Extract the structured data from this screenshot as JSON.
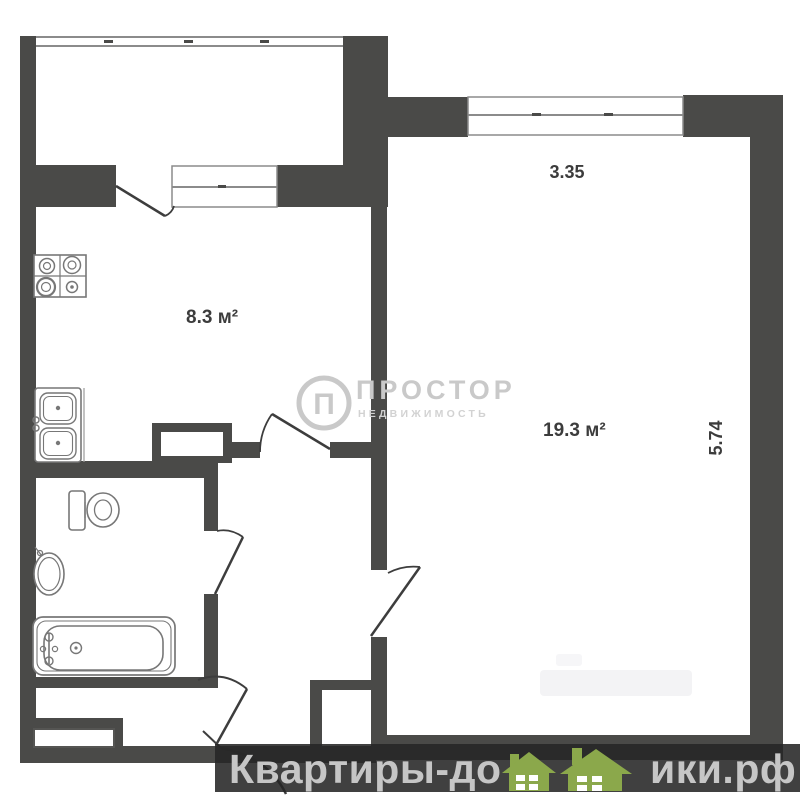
{
  "floor_plan": {
    "rooms": [
      {
        "name": "kitchen",
        "area_label": "8.3 м²"
      },
      {
        "name": "living-room",
        "area_label": "19.3 м²"
      }
    ],
    "dimension_labels": {
      "horizontal": "3.35",
      "vertical": "5.74"
    }
  },
  "agency_watermark": {
    "logo_letter": "П",
    "title": "ПРОСТОР",
    "subtitle": "НЕДВИЖИМОСТЬ"
  },
  "footer_banner": {
    "text_before_icon": "Квартиры-до",
    "text_after_icon": "ики.рф",
    "houses_icon": "green-houses-icon"
  },
  "colors": {
    "wall": "#4a4a48",
    "window_line": "#8b8b8b",
    "fixture_line": "#777777",
    "label_text": "#3c3c3c",
    "watermark_gray": "#c9c9c9",
    "banner_background": "rgba(38,38,38,0.88)",
    "banner_text": "#c6c6c6",
    "house_green": "#8ba84b"
  }
}
